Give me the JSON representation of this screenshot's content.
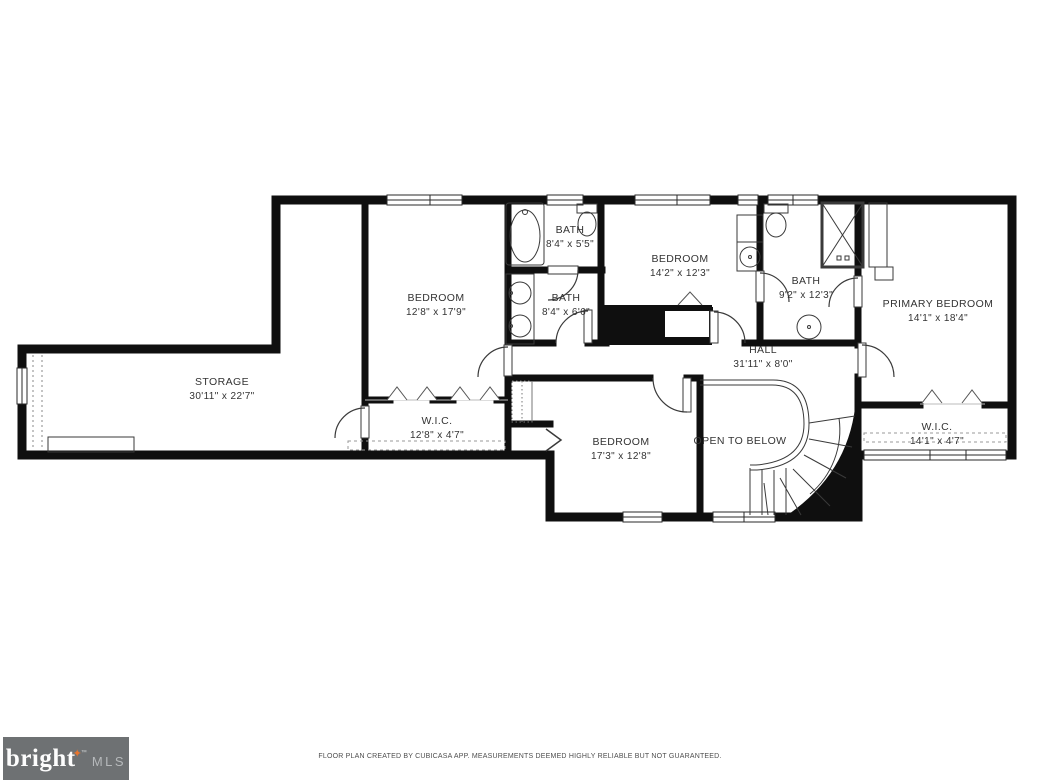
{
  "plan": {
    "rooms": {
      "storage": {
        "name": "STORAGE",
        "dims": "30'11\" x 22'7\""
      },
      "bedroom_left": {
        "name": "BEDROOM",
        "dims": "12'8\" x 17'9\""
      },
      "bath_top": {
        "name": "BATH",
        "dims": "8'4\" x 5'5\""
      },
      "bath_mid": {
        "name": "BATH",
        "dims": "8'4\" x 6'6\""
      },
      "bedroom_mid": {
        "name": "BEDROOM",
        "dims": "14'2\" x 12'3\""
      },
      "bath_primary": {
        "name": "BATH",
        "dims": "9'2\" x 12'3\""
      },
      "primary_bedroom": {
        "name": "PRIMARY BEDROOM",
        "dims": "14'1\" x 18'4\""
      },
      "hall": {
        "name": "HALL",
        "dims": "31'11\" x 8'0\""
      },
      "wic_left": {
        "name": "W.I.C.",
        "dims": "12'8\" x 4'7\""
      },
      "bedroom_bottom": {
        "name": "BEDROOM",
        "dims": "17'3\" x 12'8\""
      },
      "open_to_below": {
        "name": "OPEN TO BELOW"
      },
      "wic_primary": {
        "name": "W.I.C.",
        "dims": "14'1\" x 4'7\""
      }
    },
    "colors": {
      "wall": "#0f0f0f",
      "accent_star": "#e8742c",
      "footer_bg": "#6e7173",
      "mls_text": "#b6b9bb"
    }
  },
  "icons": {
    "logo_star": "✦"
  },
  "footer": {
    "brand": "bright",
    "trademark": "™",
    "brand_suffix": "MLS",
    "disclaimer": "FLOOR PLAN CREATED BY CUBICASA APP. MEASUREMENTS DEEMED HIGHLY RELIABLE BUT NOT GUARANTEED."
  }
}
